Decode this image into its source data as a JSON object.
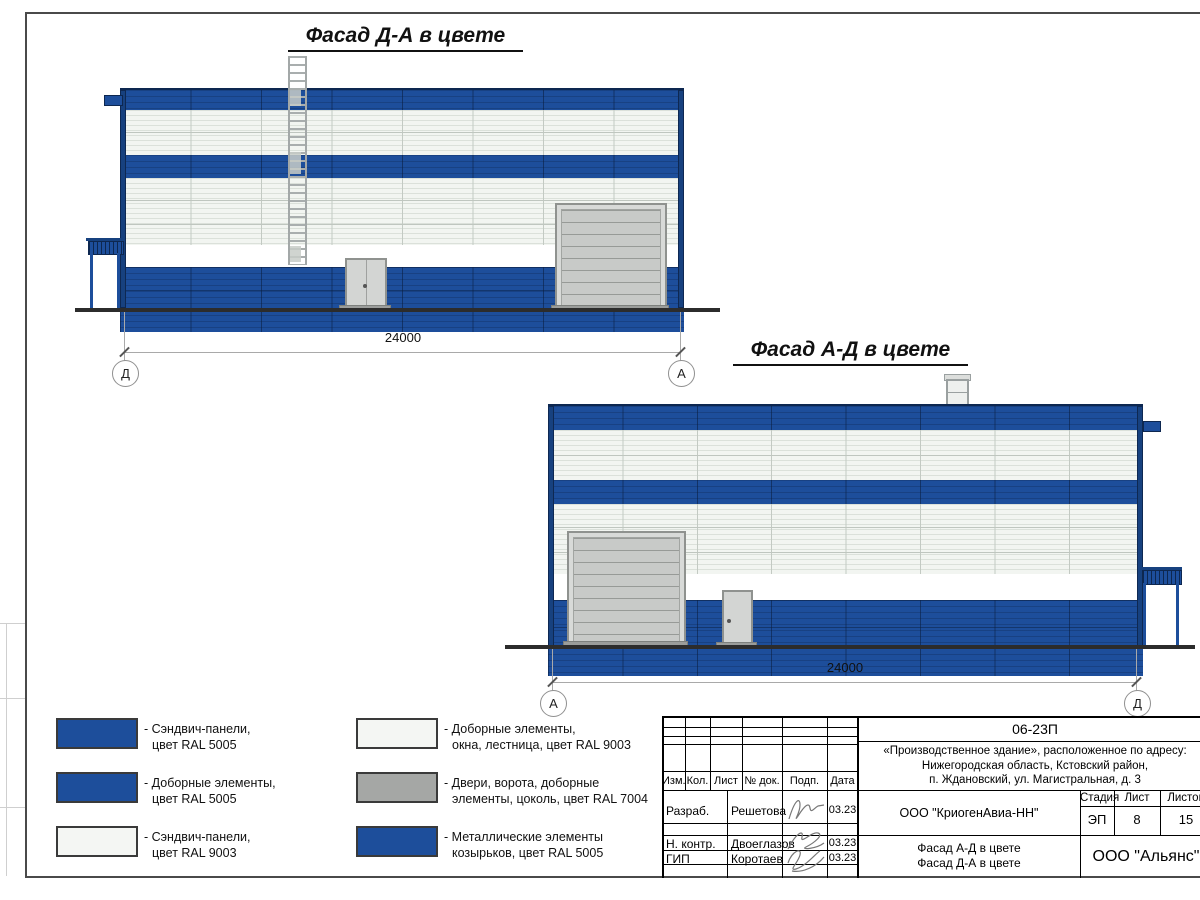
{
  "titles": {
    "facade1": "Фасад Д-А в цвете",
    "facade2": "Фасад А-Д в цвете"
  },
  "facade1": {
    "dimension": "24000",
    "axis_left": "Д",
    "axis_right": "А"
  },
  "facade2": {
    "dimension": "24000",
    "axis_left": "А",
    "axis_right": "Д"
  },
  "legend": {
    "items": [
      {
        "swatch": "blue",
        "line1": "- Сэндвич-панели,",
        "line2": "цвет RAL 5005"
      },
      {
        "swatch": "blue",
        "line1": "- Доборные элементы,",
        "line2": "цвет RAL 5005"
      },
      {
        "swatch": "white",
        "line1": "- Сэндвич-панели,",
        "line2": "цвет RAL 9003"
      },
      {
        "swatch": "white",
        "line1": "- Доборные элементы,",
        "line2": "окна, лестница, цвет RAL 9003"
      },
      {
        "swatch": "gray",
        "line1": "- Двери, ворота, доборные",
        "line2": "элементы, цоколь, цвет RAL 7004"
      },
      {
        "swatch": "blue",
        "line1": "- Металлические элементы",
        "line2": "козырьков, цвет RAL 5005"
      }
    ]
  },
  "title_block": {
    "doc_number": "06-23П",
    "address_lines": [
      "«Производственное здание», расположенное по адресу:",
      "Нижегородская область, Кстовский район,",
      "п. Ждановский, ул. Магистральная, д. 3"
    ],
    "header_cols": [
      "Изм.",
      "Кол.",
      "Лист",
      "№ док.",
      "Подп.",
      "Дата"
    ],
    "rows": [
      {
        "role": "Разраб.",
        "name": "Решетова",
        "date": "03.23"
      },
      {
        "role": "Н. контр.",
        "name": "Двоеглазов",
        "date": "03.23"
      },
      {
        "role": "ГИП",
        "name": "Коротаев",
        "date": "03.23"
      }
    ],
    "company": "ООО \"КриогенАвиа-НН\"",
    "sheet_title_lines": [
      "Фасад А-Д в цвете",
      "Фасад Д-А в цвете"
    ],
    "stage_label": "Стадия",
    "sheet_label": "Лист",
    "sheets_label": "Листов",
    "stage": "ЭП",
    "sheet": "8",
    "sheets": "15",
    "org": "ООО \"Альянс\""
  },
  "colors": {
    "ral5005_blue": "#1d4e9b",
    "ral9003_white": "#f2f5f1",
    "ral7004_gray": "#a5a7a5",
    "accent_dark_blue": "#0d2750"
  }
}
